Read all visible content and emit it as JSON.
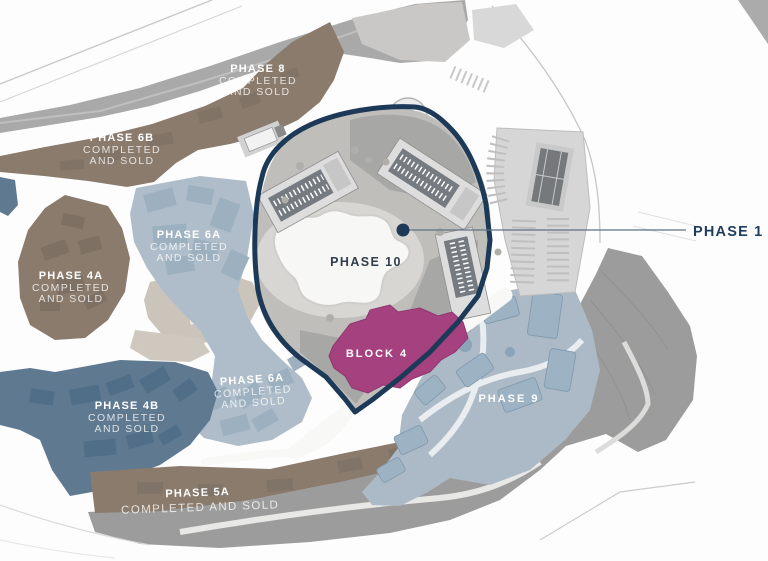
{
  "map": {
    "type": "masterplan-site-map",
    "regions": {
      "phase8": {
        "title": "PHASE 8",
        "status1": "COMPLETED",
        "status2": "AND SOLD"
      },
      "phase6b": {
        "title": "PHASE 6B",
        "status1": "COMPLETED",
        "status2": "AND SOLD"
      },
      "phase6a_north": {
        "title": "PHASE 6A",
        "status1": "COMPLETED",
        "status2": "AND SOLD"
      },
      "phase4a": {
        "title": "PHASE 4A",
        "status1": "COMPLETED",
        "status2": "AND SOLD"
      },
      "phase4b": {
        "title": "PHASE 4B",
        "status1": "COMPLETED",
        "status2": "AND SOLD"
      },
      "phase6a_south": {
        "title": "PHASE 6A",
        "status1": "COMPLETED",
        "status2": "AND SOLD"
      },
      "phase5a": {
        "title": "PHASE 5A",
        "status1": "COMPLETED AND SOLD"
      },
      "phase9": {
        "title": "PHASE 9"
      },
      "phase10": {
        "title": "PHASE 10"
      },
      "block4": {
        "title": "BLOCK 4"
      }
    },
    "callout": {
      "label": "PHASE 1"
    },
    "colors": {
      "brown_region": "#8A7B6D",
      "light_blue_region": "#ABBAC6",
      "dark_blue_region": "#5F7991",
      "magenta_block": "#A5417F",
      "navy_boundary": "#1C3A57",
      "callout_navy": "#1E3C5C",
      "slope_gray": "#9C9C9C",
      "road_gray": "#A9A9A9",
      "label_white": "#FFFFFF"
    }
  }
}
